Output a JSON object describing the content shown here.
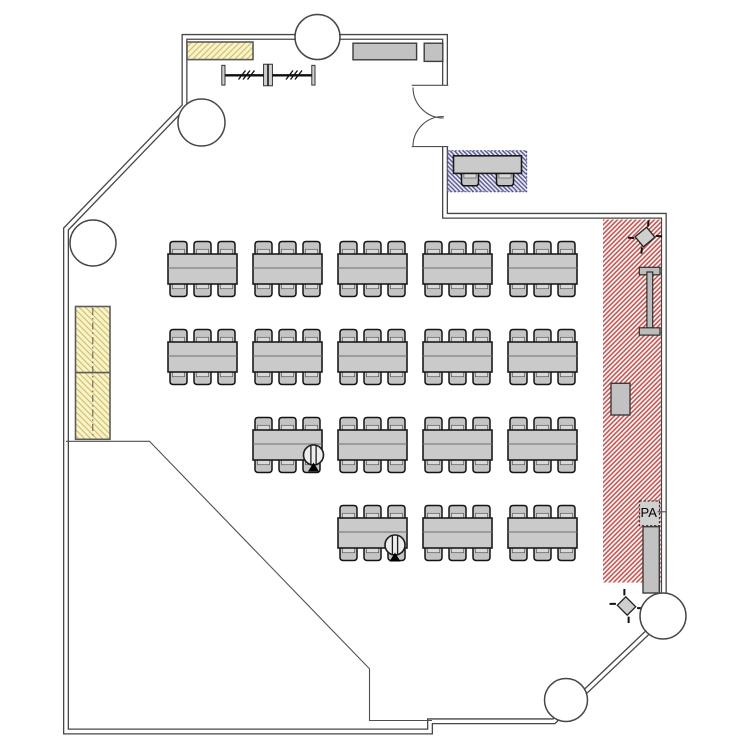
{
  "title": "Seminar room floor plan",
  "labels": {
    "pa_speaker": "PA"
  },
  "colors": {
    "wall": "#474747",
    "table_fill": "#cacaca",
    "table_stroke": "#1b1b1b",
    "chair_fill": "#c4c4c4",
    "yellow_fill": "#faf3c5",
    "yellow_hatch": "#ccbc70",
    "red_bg": "#fdf7f6",
    "red_hatch": "#bf4f4c",
    "blue_bg": "#ebebf5",
    "blue_hatch": "#52528b",
    "fixture_fill": "#c2c2c2",
    "fixture_stroke": "#3c3c3c"
  },
  "furniture": {
    "table": {
      "w": 69,
      "h": 30
    },
    "chair": {
      "w": 17,
      "h": 13
    },
    "chair_offsets": [
      2,
      26,
      50
    ],
    "column_starts_x": [
      168,
      253,
      338,
      423,
      508
    ],
    "rows": [
      {
        "y": 254,
        "columns": [
          0,
          1,
          2,
          3,
          4
        ]
      },
      {
        "y": 342,
        "columns": [
          0,
          1,
          2,
          3,
          4
        ]
      },
      {
        "y": 430,
        "columns": [
          1,
          2,
          3,
          4
        ]
      },
      {
        "y": 518,
        "columns": [
          2,
          3,
          4
        ]
      }
    ],
    "total_tables": 17
  },
  "structural_columns": [
    {
      "cx": 317.5,
      "cy": 37,
      "r": 22.5
    },
    {
      "cx": 201.5,
      "cy": 122.5,
      "r": 23.5
    },
    {
      "cx": 93,
      "cy": 243,
      "r": 23
    },
    {
      "cx": 566,
      "cy": 700,
      "r": 21.5
    },
    {
      "cx": 663,
      "cy": 616,
      "r": 23
    }
  ],
  "floor_outlets": [
    {
      "cx": 313.5,
      "cy": 455
    },
    {
      "cx": 395,
      "cy": 545
    }
  ]
}
